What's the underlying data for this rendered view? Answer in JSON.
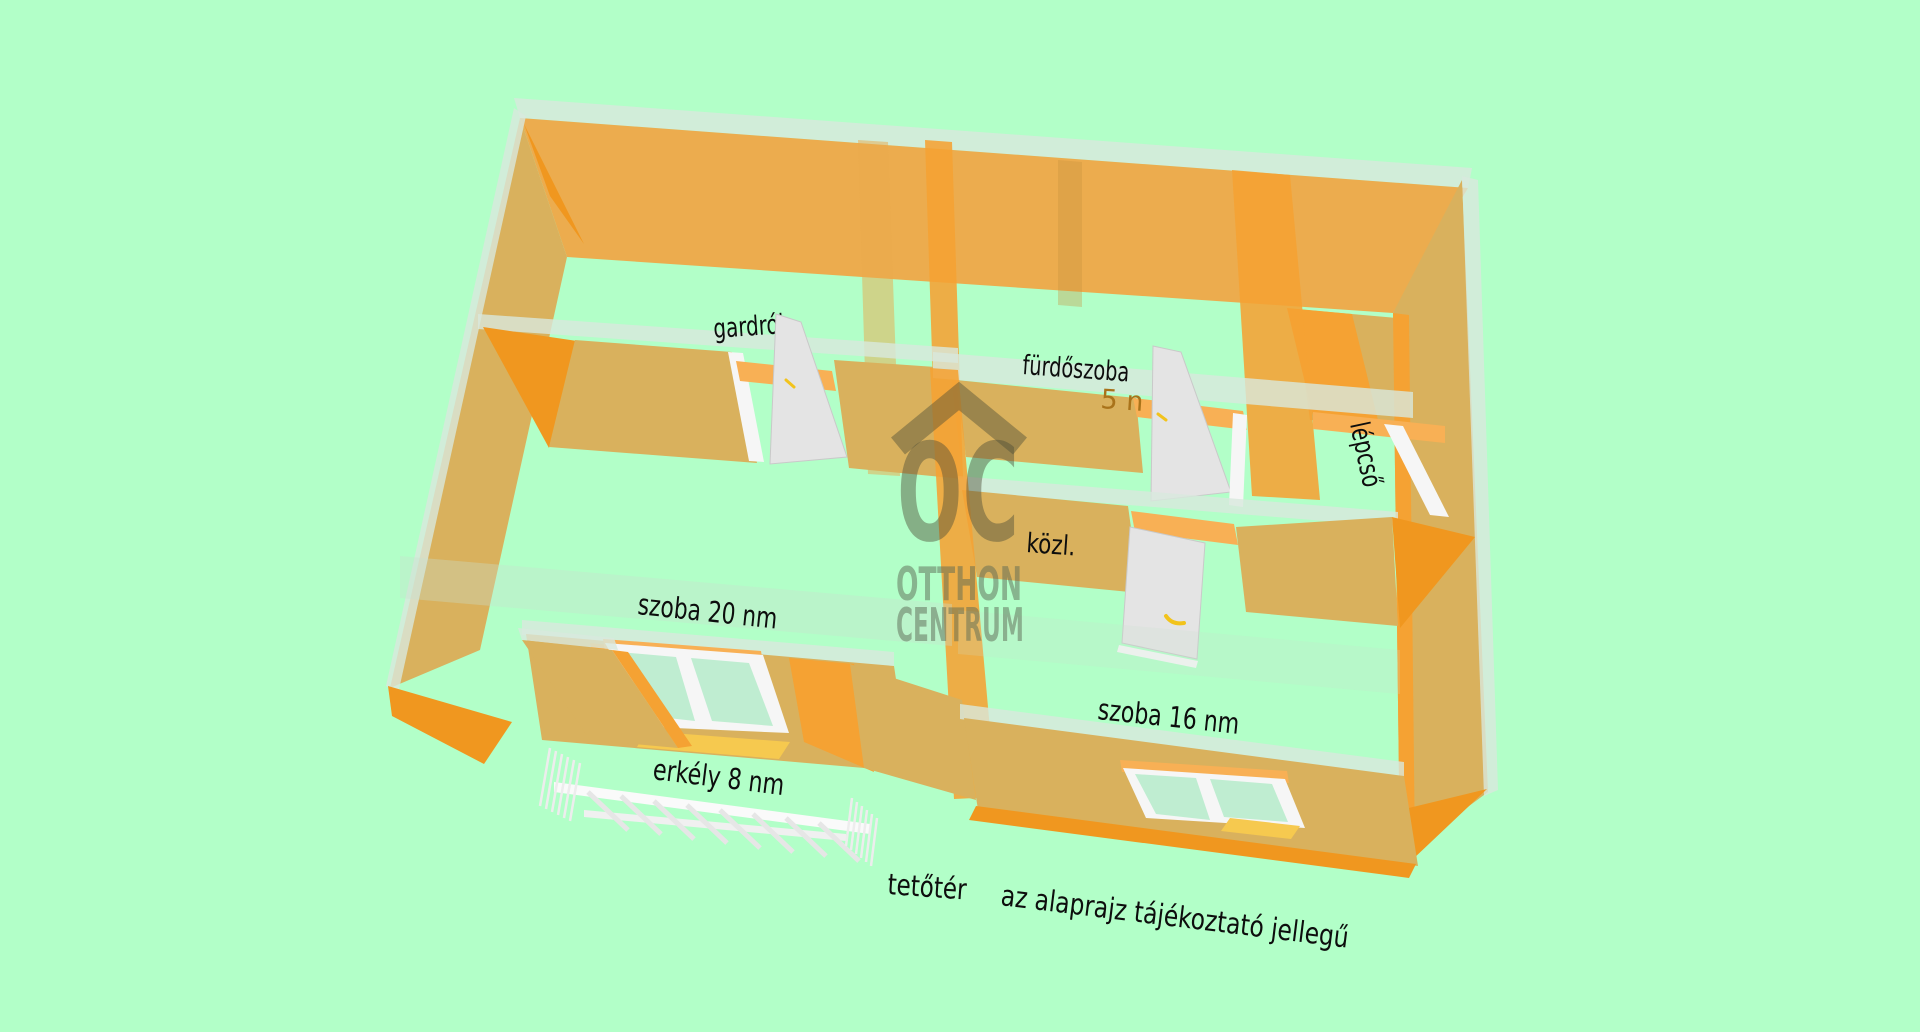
{
  "palette": {
    "bg": "#B2FFC8",
    "wall_face": "#ECAC4E",
    "wall_side": "#D9B15D",
    "wall_bright": "#F5A233",
    "cap_orange": "#F0971F",
    "lintel": "#F8B055",
    "top_strip": "#D8E9DD",
    "door_leaf": "#E4E4E4",
    "frame_white": "#F6F6F6",
    "glass": "#BFEDD1",
    "sill": "#F6C94F",
    "handle": "#F2C31C",
    "wm_dark": "#4F4F38",
    "wm_light": "#5E6B55",
    "label": "#0D0D0D",
    "area_label": "#A9731A"
  },
  "watermark": {
    "logo": "OC",
    "line1": "OTTHON",
    "line2": "CENTRUM"
  },
  "labels": {
    "gardrob": "gardrób",
    "furdoszoba": "fürdőszoba",
    "furdoszoba_area": "5 n",
    "lepcso": "lépcső",
    "kozl": "közl.",
    "szoba20": "szoba 20 nm",
    "szoba16": "szoba 16 nm",
    "erkely": "erkély 8 nm",
    "tetoter": "tetőtér",
    "disclaimer": "az alaprajz tájékoztató jellegű"
  }
}
